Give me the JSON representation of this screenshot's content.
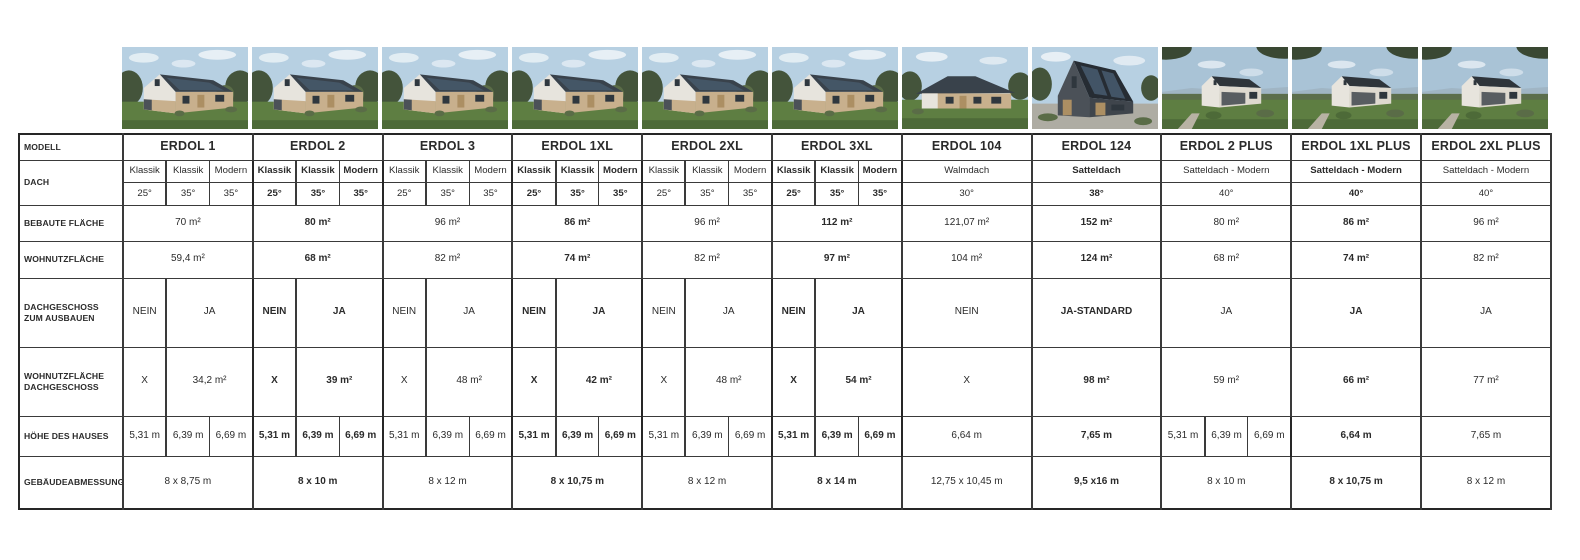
{
  "table": {
    "row_labels": {
      "modell": "MODELL",
      "dach": "DACH",
      "bebaute_flaeche": "BEBAUTE FLÄCHE",
      "wohnutzflaeche": "WOHNUTZFLÄCHE",
      "dachgeschoss": "DACHGESCHOSS ZUM AUSBAUEN",
      "wohnutzflaeche_dg": "WOHNUTZFLÄCHE DACHGESCHOSS",
      "hoehe": "HÖHE DES HAUSES",
      "abmessung": "GEBÄUDEABMESSUNG"
    },
    "models": [
      {
        "name": "ERDOL 1",
        "emphasis": false,
        "photo": "classic",
        "dach_types": [
          "Klassik",
          "Klassik",
          "Modern"
        ],
        "dach_degrees": [
          "25°",
          "35°",
          "35°"
        ],
        "bebaute_flaeche": "70 m²",
        "wohnutzflaeche": "59,4 m²",
        "dachgeschoss": [
          "NEIN",
          "JA"
        ],
        "wohnutzflaeche_dg": [
          "X",
          "34,2 m²"
        ],
        "hoehe": [
          "5,31 m",
          "6,39 m",
          "6,69 m"
        ],
        "abmessung": "8 x 8,75 m"
      },
      {
        "name": "ERDOL 2",
        "emphasis": true,
        "photo": "classic",
        "dach_types": [
          "Klassik",
          "Klassik",
          "Modern"
        ],
        "dach_degrees": [
          "25°",
          "35°",
          "35°"
        ],
        "bebaute_flaeche": "80 m²",
        "wohnutzflaeche": "68 m²",
        "dachgeschoss": [
          "NEIN",
          "JA"
        ],
        "wohnutzflaeche_dg": [
          "X",
          "39 m²"
        ],
        "hoehe": [
          "5,31 m",
          "6,39 m",
          "6,69 m"
        ],
        "abmessung": "8 x 10 m"
      },
      {
        "name": "ERDOL 3",
        "emphasis": false,
        "photo": "classic",
        "dach_types": [
          "Klassik",
          "Klassik",
          "Modern"
        ],
        "dach_degrees": [
          "25°",
          "35°",
          "35°"
        ],
        "bebaute_flaeche": "96 m²",
        "wohnutzflaeche": "82 m²",
        "dachgeschoss": [
          "NEIN",
          "JA"
        ],
        "wohnutzflaeche_dg": [
          "X",
          "48 m²"
        ],
        "hoehe": [
          "5,31 m",
          "6,39 m",
          "6,69 m"
        ],
        "abmessung": "8 x 12 m"
      },
      {
        "name": "ERDOL 1XL",
        "emphasis": true,
        "photo": "classic",
        "dach_types": [
          "Klassik",
          "Klassik",
          "Modern"
        ],
        "dach_degrees": [
          "25°",
          "35°",
          "35°"
        ],
        "bebaute_flaeche": "86 m²",
        "wohnutzflaeche": "74 m²",
        "dachgeschoss": [
          "NEIN",
          "JA"
        ],
        "wohnutzflaeche_dg": [
          "X",
          "42 m²"
        ],
        "hoehe": [
          "5,31 m",
          "6,39 m",
          "6,69 m"
        ],
        "abmessung": "8 x 10,75 m"
      },
      {
        "name": "ERDOL 2XL",
        "emphasis": false,
        "photo": "classic",
        "dach_types": [
          "Klassik",
          "Klassik",
          "Modern"
        ],
        "dach_degrees": [
          "25°",
          "35°",
          "35°"
        ],
        "bebaute_flaeche": "96 m²",
        "wohnutzflaeche": "82 m²",
        "dachgeschoss": [
          "NEIN",
          "JA"
        ],
        "wohnutzflaeche_dg": [
          "X",
          "48 m²"
        ],
        "hoehe": [
          "5,31 m",
          "6,39 m",
          "6,69 m"
        ],
        "abmessung": "8 x 12 m"
      },
      {
        "name": "ERDOL 3XL",
        "emphasis": true,
        "photo": "classic",
        "dach_types": [
          "Klassik",
          "Klassik",
          "Modern"
        ],
        "dach_degrees": [
          "25°",
          "35°",
          "35°"
        ],
        "bebaute_flaeche": "112 m²",
        "wohnutzflaeche": "97 m²",
        "dachgeschoss": [
          "NEIN",
          "JA"
        ],
        "wohnutzflaeche_dg": [
          "X",
          "54 m²"
        ],
        "hoehe": [
          "5,31 m",
          "6,39 m",
          "6,69 m"
        ],
        "abmessung": "8 x 14 m"
      },
      {
        "name": "ERDOL 104",
        "emphasis": false,
        "photo": "walmdach",
        "dach_types": [
          "Walmdach"
        ],
        "dach_degrees": [
          "30°"
        ],
        "bebaute_flaeche": "121,07 m²",
        "wohnutzflaeche": "104 m²",
        "dachgeschoss": [
          "NEIN"
        ],
        "wohnutzflaeche_dg": [
          "X"
        ],
        "hoehe": [
          "6,64 m"
        ],
        "abmessung": "12,75 x 10,45 m"
      },
      {
        "name": "ERDOL 124",
        "emphasis": true,
        "photo": "modern",
        "dach_types": [
          "Satteldach"
        ],
        "dach_degrees": [
          "38°"
        ],
        "bebaute_flaeche": "152 m²",
        "wohnutzflaeche": "124 m²",
        "dachgeschoss": [
          "JA-STANDARD"
        ],
        "wohnutzflaeche_dg": [
          "98 m²"
        ],
        "hoehe": [
          "7,65 m"
        ],
        "abmessung": "9,5 x16 m"
      },
      {
        "name": "ERDOL 2 PLUS",
        "emphasis": false,
        "photo": "plus",
        "dach_types": [
          "Satteldach - Modern"
        ],
        "dach_degrees": [
          "40°"
        ],
        "bebaute_flaeche": "80 m²",
        "wohnutzflaeche": "68 m²",
        "dachgeschoss": [
          "JA"
        ],
        "wohnutzflaeche_dg": [
          "59 m²"
        ],
        "hoehe": [
          "5,31 m",
          "6,39 m",
          "6,69 m"
        ],
        "abmessung": "8 x 10 m"
      },
      {
        "name": "ERDOL 1XL PLUS",
        "emphasis": true,
        "photo": "plus",
        "dach_types": [
          "Satteldach - Modern"
        ],
        "dach_degrees": [
          "40°"
        ],
        "bebaute_flaeche": "86 m²",
        "wohnutzflaeche": "74 m²",
        "dachgeschoss": [
          "JA"
        ],
        "wohnutzflaeche_dg": [
          "66 m²"
        ],
        "hoehe": [
          "6,64 m"
        ],
        "abmessung": "8 x 10,75 m"
      },
      {
        "name": "ERDOL 2XL PLUS",
        "emphasis": false,
        "photo": "plus",
        "dach_types": [
          "Satteldach - Modern"
        ],
        "dach_degrees": [
          "40°"
        ],
        "bebaute_flaeche": "96 m²",
        "wohnutzflaeche": "82 m²",
        "dachgeschoss": [
          "JA"
        ],
        "wohnutzflaeche_dg": [
          "77 m²"
        ],
        "hoehe": [
          "7,65 m"
        ],
        "abmessung": "8 x 12 m"
      }
    ]
  },
  "photos": {
    "icon_name": "house-photo",
    "palette": {
      "sky": "#b7d0e2",
      "sky_plus": "#a9c3d6",
      "cloud": "#e7eff5",
      "tree_dark": "#44543b",
      "tree_mid": "#5a6c47",
      "canopy": "#3a4833",
      "grass": "#5e7e42",
      "grass_dark": "#4d6a38",
      "roof": "#39424b",
      "roof_plus": "#2e343a",
      "solar": "#46596b",
      "wall_white": "#e7e4dd",
      "wall_cream": "#ded9cf",
      "wall_beige": "#c8b08d",
      "wall_dark": "#4b5158",
      "wood": "#ac8f63",
      "window": "#2f373e",
      "gravel": "#aeaca3",
      "hill": "#9db1bf",
      "hedge": "#5c6e4c",
      "path": "#b8b2a4"
    }
  }
}
